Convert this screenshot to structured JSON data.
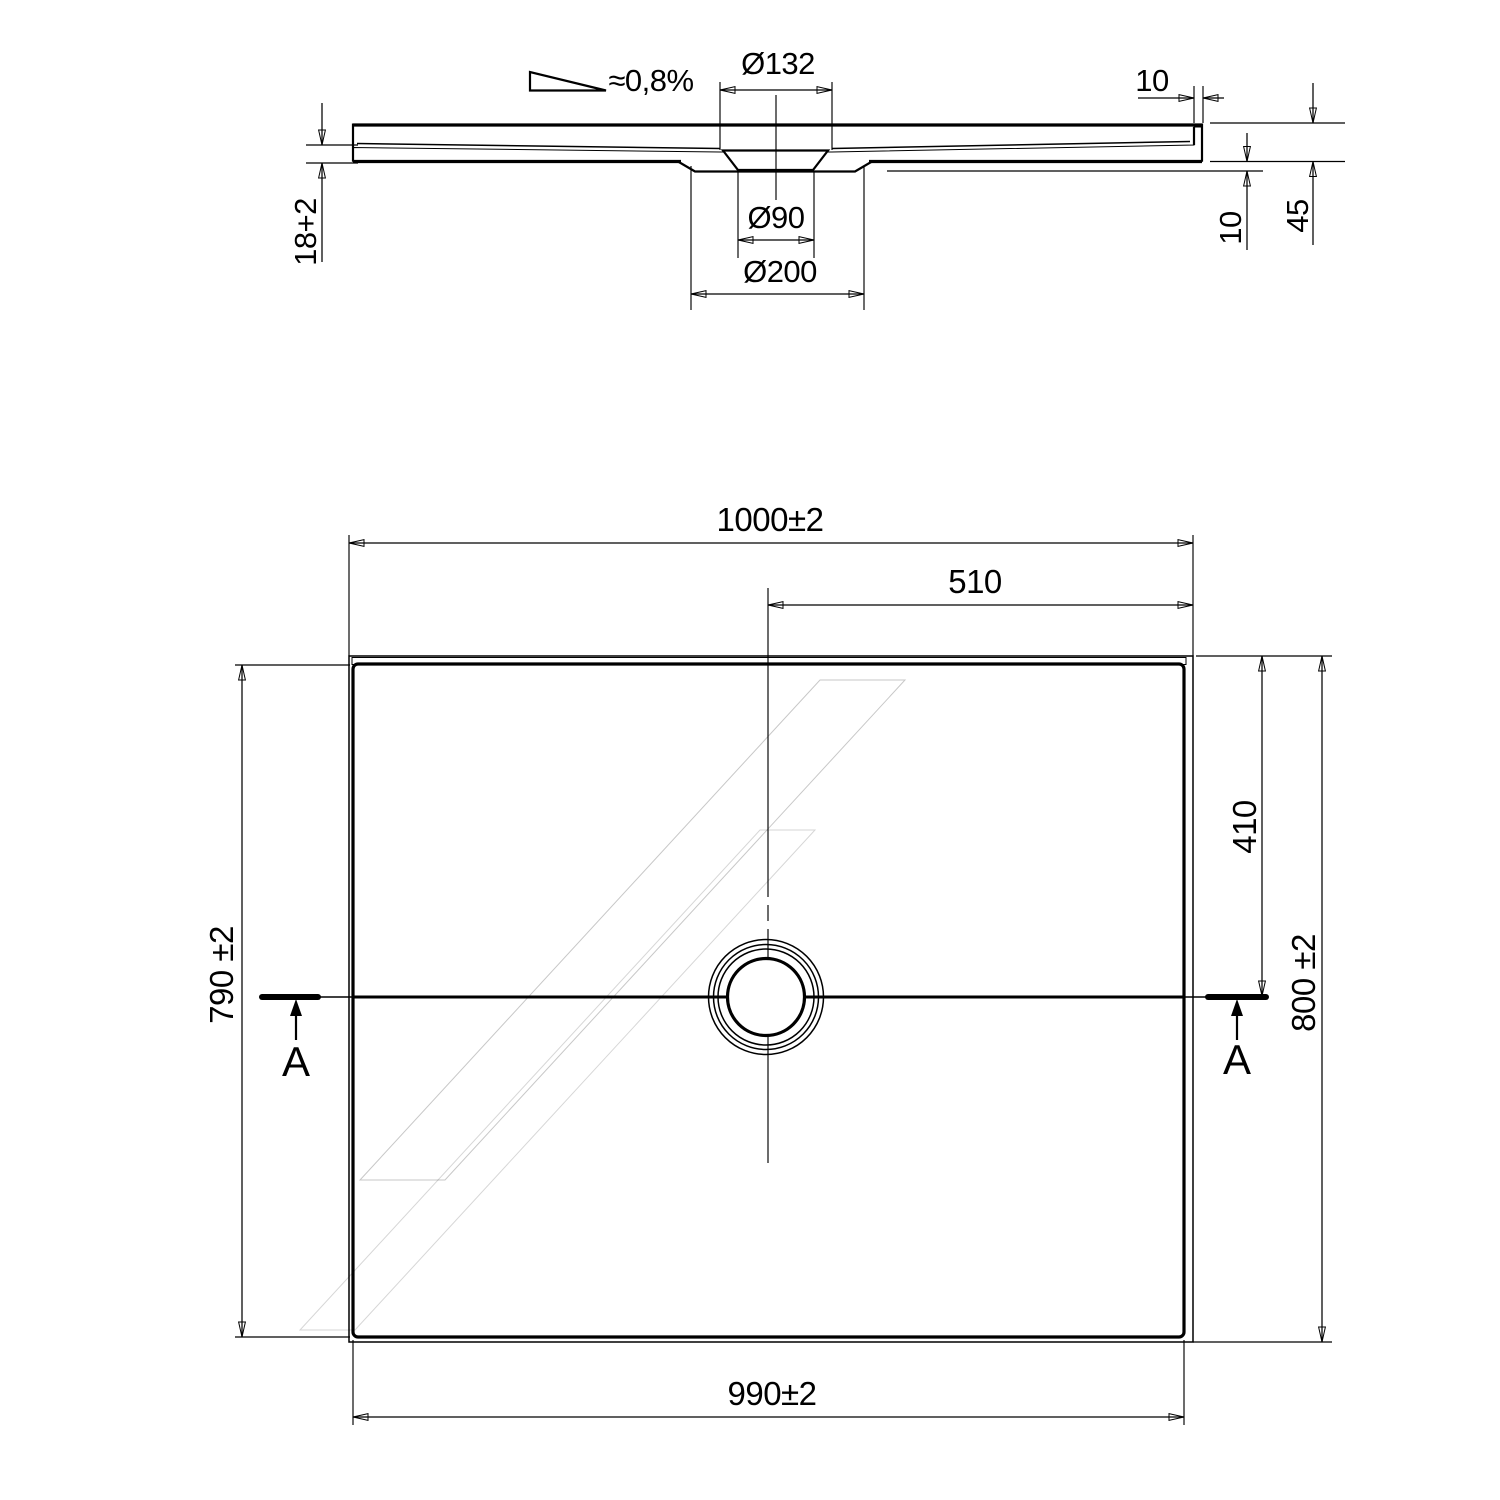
{
  "section": {
    "slope_label": "≈0,8%",
    "diameter_top": "Ø132",
    "diameter_waste": "Ø90",
    "diameter_recess": "Ø200",
    "edge_thickness": "18+2",
    "rim_width": "10",
    "base_clearance": "10",
    "total_height": "45"
  },
  "plan": {
    "width_top": "1000±2",
    "drain_offset_x": "510",
    "height_left": "790 ±2",
    "height_right": "800 ±2",
    "drain_offset_y": "410",
    "width_bottom": "990±2",
    "cut_label_left": "A",
    "cut_label_right": "A"
  },
  "colors": {
    "line": "#000000",
    "tray_fill": "#d9d9d9",
    "section_fill": "#a8a8a8"
  }
}
